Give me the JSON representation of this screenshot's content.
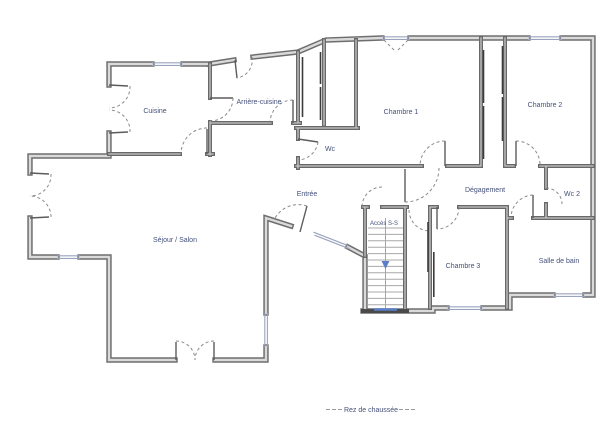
{
  "rooms": {
    "cuisine": {
      "label": "Cuisine"
    },
    "arriere_cuisine": {
      "label": "Arrière-cuisine"
    },
    "chambre1": {
      "label": "Chambre 1"
    },
    "chambre2": {
      "label": "Chambre 2"
    },
    "wc": {
      "label": "Wc"
    },
    "degagement": {
      "label": "Dégagement"
    },
    "wc2": {
      "label": "Wc 2"
    },
    "entree": {
      "label": "Entrée"
    },
    "acces_ss": {
      "label": "Accès S-S"
    },
    "sejour": {
      "label": "Séjour / Salon"
    },
    "chambre3": {
      "label": "Chambre 3"
    },
    "salle_de_bain": {
      "label": "Salle de bain"
    }
  },
  "legend": {
    "floor_label": "Rez de chaussée"
  },
  "colors": {
    "wall_casing": "#6e6e6e",
    "wall_fill": "#dadada",
    "label_text": "#44507a",
    "stair_accent": "#5b7fc7",
    "door_arc": "#8a8a8a",
    "background": "#ffffff"
  }
}
